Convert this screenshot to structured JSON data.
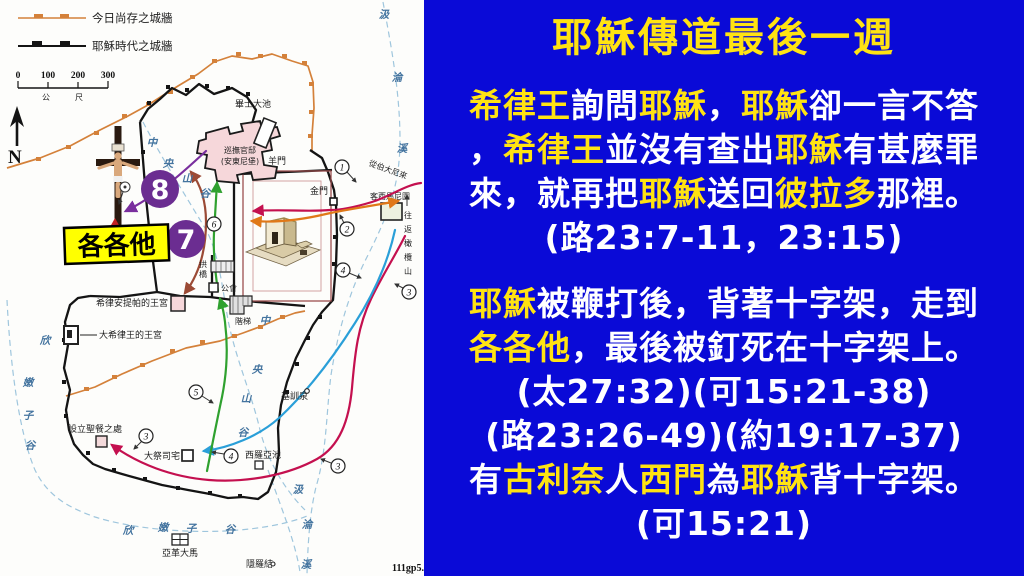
{
  "panel": {
    "bg": "#0a0ad7",
    "accent_yellow": "#ffe312",
    "text_white": "#ffffff",
    "title": "耶穌傳道最後一週",
    "p1": [
      [
        {
          "t": "希律王",
          "c": "y"
        },
        {
          "t": "詢問",
          "c": "w"
        },
        {
          "t": "耶穌",
          "c": "y"
        },
        {
          "t": "，",
          "c": "w"
        },
        {
          "t": "耶穌",
          "c": "y"
        },
        {
          "t": "卻一言不答",
          "c": "w"
        }
      ],
      [
        {
          "t": "，",
          "c": "w"
        },
        {
          "t": "希律王",
          "c": "y"
        },
        {
          "t": "並沒有查出",
          "c": "w"
        },
        {
          "t": "耶穌",
          "c": "y"
        },
        {
          "t": "有甚麼罪",
          "c": "w"
        }
      ],
      [
        {
          "t": "來，就再把",
          "c": "w"
        },
        {
          "t": "耶穌",
          "c": "y"
        },
        {
          "t": "送回",
          "c": "w"
        },
        {
          "t": "彼拉多",
          "c": "y"
        },
        {
          "t": "那裡。",
          "c": "w"
        }
      ],
      [
        {
          "t": "(路23:7-11，23:15)",
          "c": "w"
        }
      ]
    ],
    "p2": [
      [
        {
          "t": "耶穌",
          "c": "y"
        },
        {
          "t": "被鞭打後，背著十字架，走到",
          "c": "w"
        }
      ],
      [
        {
          "t": "各各他",
          "c": "y"
        },
        {
          "t": "，最後被釘死在十字架上。",
          "c": "w"
        }
      ],
      [
        {
          "t": "(太27:32)(可15:21-38)",
          "c": "w"
        }
      ],
      [
        {
          "t": "(路23:26-49)(約19:17-37)",
          "c": "w"
        }
      ],
      [
        {
          "t": "有",
          "c": "w"
        },
        {
          "t": "古利奈",
          "c": "y"
        },
        {
          "t": "人",
          "c": "w"
        },
        {
          "t": "西門",
          "c": "y"
        },
        {
          "t": "為",
          "c": "w"
        },
        {
          "t": "耶穌",
          "c": "y"
        },
        {
          "t": "背十字架。",
          "c": "w"
        }
      ],
      [
        {
          "t": "(可15:21)",
          "c": "w"
        }
      ]
    ]
  },
  "map": {
    "legend": {
      "modern_wall": "今日尚存之城牆",
      "jesus_wall": "耶穌時代之城牆",
      "modern_color": "#d4813a",
      "jesus_color": "#141414"
    },
    "scale": {
      "ticks": [
        "0",
        "100",
        "200",
        "300"
      ],
      "unit_left": "公",
      "unit_right": "尺"
    },
    "north": "N",
    "labels": {
      "bethesda": "畢士大池",
      "praetorium1": "巡撫官邸",
      "praetorium2": "(安東尼堡)",
      "sheep_gate": "羊門",
      "golden_gate": "金門",
      "gethsemane": "客西馬尼園",
      "from_bethany": "從伯大尼來",
      "olives": [
        "往",
        "返",
        "橄",
        "欖",
        "山"
      ],
      "sanhedrin": "公會",
      "stairs": "階梯",
      "bridge": [
        "拱",
        "橋"
      ],
      "herod_antipas": "希律安提帕的王宮",
      "herod_great": "大希律王的王宮",
      "last_supper": "設立聖餐之處",
      "high_priest": "大祭司宅",
      "siloam": "西羅亞池",
      "gihon": "基訓泉",
      "akeldama": "亞革大馬",
      "enrogel": "隱羅結",
      "golgotha": "各各他",
      "kidron": [
        "汲",
        "淪",
        "溪"
      ],
      "central_valley": [
        "中",
        "央",
        "山",
        "谷"
      ],
      "hinnom": [
        "欣",
        "嫩",
        "子",
        "谷"
      ],
      "credit": "111gp5."
    },
    "nums": {
      "n1": "1",
      "n2": "2",
      "n3": "3",
      "n4": "4",
      "n5": "5",
      "n6": "6",
      "n7": "7",
      "n8": "8"
    },
    "route_colors": {
      "crimson": "#c4104f",
      "orange": "#e07818",
      "blue": "#2a9fd8",
      "green": "#2fa12f",
      "brown": "#9b4a35",
      "purple": "#7a2f9e",
      "big_circle": "#6b2d91",
      "golgotha_box": "#ffff00"
    }
  }
}
